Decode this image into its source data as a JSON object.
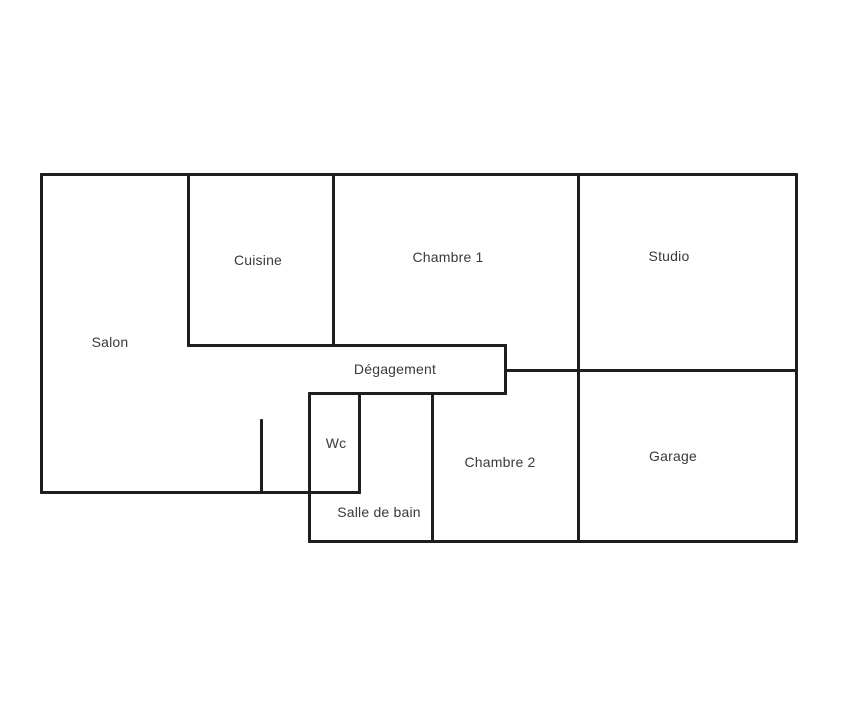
{
  "colors": {
    "background": "#ffffff",
    "wall": "#1e1e1e",
    "label_text": "#3a3a3a"
  },
  "floorplan": {
    "rooms": [
      {
        "id": "salon",
        "label": "Salon",
        "cx": 110,
        "cy": 342
      },
      {
        "id": "cuisine",
        "label": "Cuisine",
        "cx": 258,
        "cy": 260
      },
      {
        "id": "chambre-1",
        "label": "Chambre 1",
        "cx": 448,
        "cy": 257
      },
      {
        "id": "studio",
        "label": "Studio",
        "cx": 669,
        "cy": 256
      },
      {
        "id": "degagement",
        "label": "Dégagement",
        "cx": 395,
        "cy": 369
      },
      {
        "id": "wc",
        "label": "Wc",
        "cx": 336,
        "cy": 443
      },
      {
        "id": "chambre-2",
        "label": "Chambre 2",
        "cx": 500,
        "cy": 462
      },
      {
        "id": "garage",
        "label": "Garage",
        "cx": 673,
        "cy": 456
      },
      {
        "id": "salle-de-bain",
        "label": "Salle de bain",
        "cx": 379,
        "cy": 512
      }
    ],
    "walls": [
      {
        "id": "outer-top",
        "x": 40,
        "y": 173,
        "w": 758,
        "h": 3
      },
      {
        "id": "cuisine-bottom-degagement-top",
        "x": 187,
        "y": 344,
        "w": 320,
        "h": 3
      },
      {
        "id": "studio-garage-divider",
        "x": 504,
        "y": 369,
        "w": 294,
        "h": 3
      },
      {
        "id": "degagement-bottom",
        "x": 308,
        "y": 392,
        "w": 199,
        "h": 3
      },
      {
        "id": "salon-bottom-wc-bottom",
        "x": 40,
        "y": 491,
        "w": 321,
        "h": 3
      },
      {
        "id": "outer-bottom",
        "x": 308,
        "y": 540,
        "w": 490,
        "h": 3
      },
      {
        "id": "outer-left",
        "x": 40,
        "y": 173,
        "w": 3,
        "h": 321
      },
      {
        "id": "salon-cuisine-divider",
        "x": 187,
        "y": 173,
        "w": 3,
        "h": 174
      },
      {
        "id": "cuisine-chambre1-divider",
        "x": 332,
        "y": 173,
        "w": 3,
        "h": 174
      },
      {
        "id": "chambre1-studio-divider",
        "x": 577,
        "y": 173,
        "w": 3,
        "h": 370
      },
      {
        "id": "outer-right",
        "x": 795,
        "y": 173,
        "w": 3,
        "h": 370
      },
      {
        "id": "degagement-right",
        "x": 504,
        "y": 344,
        "w": 3,
        "h": 51
      },
      {
        "id": "wc-salle-de-bain-left",
        "x": 308,
        "y": 392,
        "w": 3,
        "h": 151
      },
      {
        "id": "wc-right",
        "x": 358,
        "y": 392,
        "w": 3,
        "h": 102
      },
      {
        "id": "salledebain-chambre2-divider",
        "x": 431,
        "y": 392,
        "w": 3,
        "h": 151
      },
      {
        "id": "salon-door-stub",
        "x": 260,
        "y": 419,
        "w": 3,
        "h": 75
      }
    ]
  }
}
